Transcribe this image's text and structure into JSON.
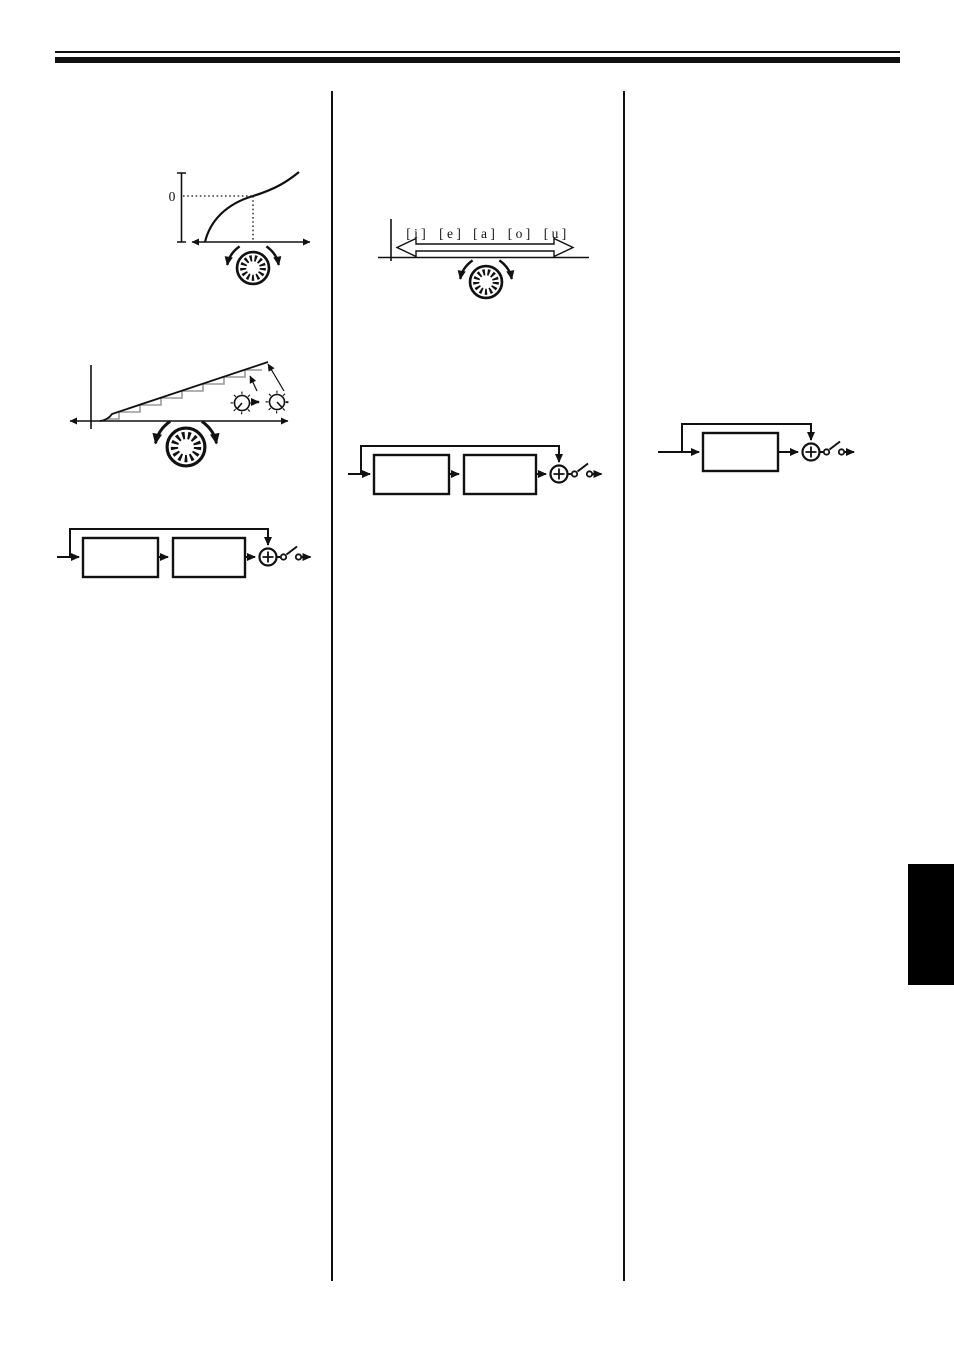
{
  "figures": {
    "velocity_curve": {
      "zero_label": "0",
      "icons": [
        "rotary-dial-icon",
        "rotate-ccw-arrow-icon",
        "rotate-cw-arrow-icon"
      ]
    },
    "staircase_graph": {
      "icons": [
        "knob-before-icon",
        "arrow-right-icon",
        "knob-after-icon",
        "rotary-dial-icon"
      ]
    },
    "vowel_scale": {
      "labels": [
        "[ i ]",
        "[ e ]",
        "[ a ]",
        "[ o ]",
        "[ u ]"
      ],
      "icons": [
        "double-headed-arrow-icon",
        "rotary-dial-icon"
      ]
    },
    "two_stage_diagram_left": {
      "icons": [
        "sum-node-icon",
        "open-switch-icon"
      ]
    },
    "two_stage_diagram_middle": {
      "icons": [
        "sum-node-icon",
        "open-switch-icon"
      ]
    },
    "single_stage_diagram_right": {
      "icons": [
        "sum-node-icon",
        "open-switch-icon"
      ]
    }
  },
  "colors": {
    "ink": "#111111",
    "staircase_steps": "#999999",
    "side_tab": "#000000",
    "background": "#ffffff"
  }
}
